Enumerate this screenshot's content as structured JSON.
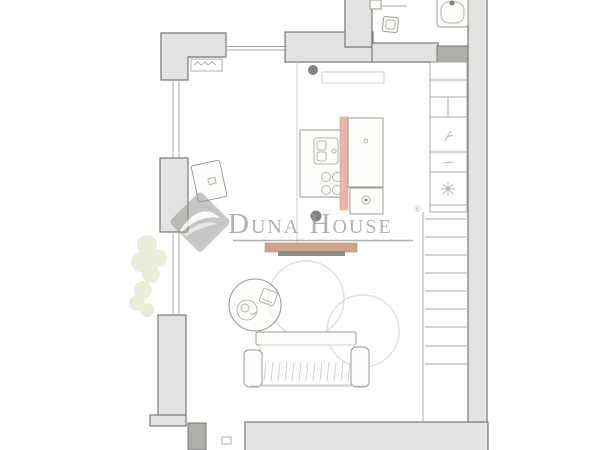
{
  "watermark": {
    "brand": "Duna House",
    "registered": "®",
    "color": "#9d9a97"
  },
  "colors": {
    "wall_fill": "#e3e3e1",
    "wall_dark": "#aeaeab",
    "wall_outline": "#77777a",
    "shelf_tan": "#cba68c",
    "shelf_shadow": "#8d8d8a",
    "accent_salmon": "#e9b6a7",
    "greenery": "#e4ecd2",
    "column_dot": "#82827f",
    "watermark_gray": "#9d9a97",
    "paper": "#ffffff"
  }
}
